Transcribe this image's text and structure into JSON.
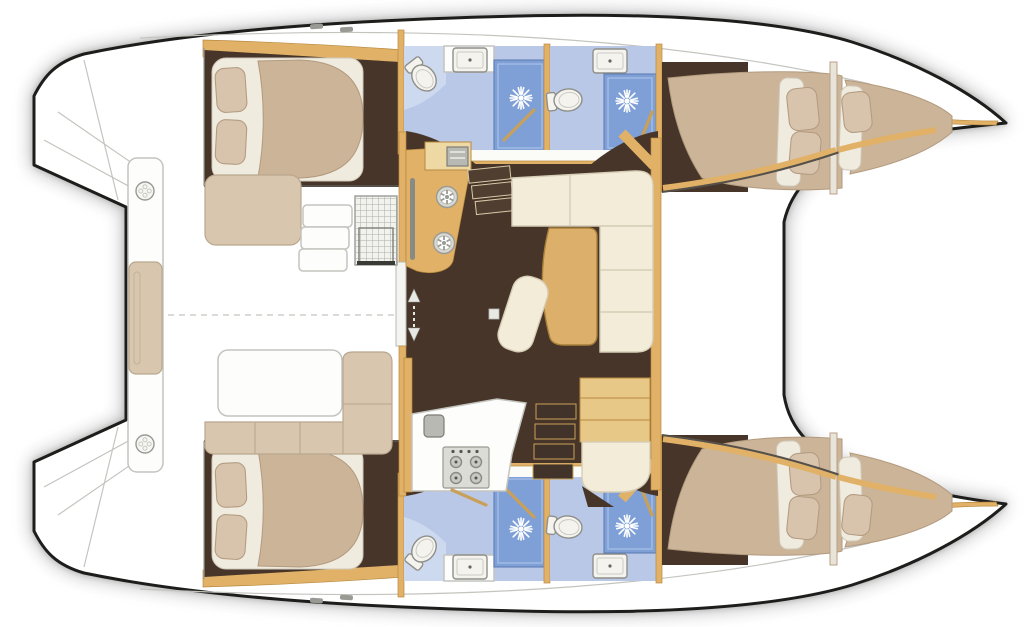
{
  "title": "Catamaran interior layout — overhead floor plan",
  "vessel": {
    "type": "catamaran",
    "view": "top-down interior plan",
    "hulls": 2,
    "cabins": 4,
    "bathrooms": 4
  },
  "colors": {
    "hull_outline": "#1d1d1b",
    "deck_white": "#ffffff",
    "shadow": "rgba(120,120,120,0.45)",
    "line_grey": "#c4c4bf",
    "steel_grey": "#b9b9b3",
    "floor_line": "#55504a",
    "wood_trim": "#e0b166",
    "wood_light": "#eed9a4",
    "wood_dark": "#b8893f",
    "table_wood": "#dcb06a",
    "stair_wood": "#c9a05a",
    "floor_dark": "#463528",
    "sofa_cream": "#f3ecd9",
    "sofa_edge": "#d6cdb5",
    "cushion_tan": "#d8c6ae",
    "cushion_edge": "#b9a88e",
    "bed_quilt": "#ccb499",
    "bed_quilt_edge": "#b29a7e",
    "bed_sheet": "#f0ebdf",
    "pillow": "#d8c4ad",
    "pillow_edge": "#b49c82",
    "bath_floor": "#b9c8e7",
    "bath_panel": "#cdd9ef",
    "shower_blue": "#7fa0d6",
    "shower_edge": "#5978b2",
    "fixture_white": "#f5f3ee",
    "fixture_stroke": "#8f8f89"
  },
  "areas": {
    "port_hull": {
      "label": "Port hull (top)",
      "rooms": [
        "aft double cabin",
        "bathroom with shower",
        "bathroom with shower",
        "forward double cabin",
        "forepeak berth"
      ]
    },
    "starboard_hull": {
      "label": "Starboard hull (bottom)",
      "rooms": [
        "aft double cabin",
        "bathroom with shower",
        "bathroom with shower",
        "forward double cabin",
        "forepeak berth"
      ]
    },
    "saloon": {
      "label": "Saloon and galley",
      "features": [
        "galley counter with twin rings",
        "L-shaped sofa",
        "dining table",
        "chaise seat",
        "galley counter with 4-burner stove and sink",
        "navigation desk with seat",
        "companionway stairs port",
        "companionway stairs starboard"
      ]
    },
    "cockpit": {
      "label": "Aft cockpit",
      "features": [
        "transom bench with cushion",
        "deck hatch",
        "deck hatch",
        "side seat",
        "boarding steps",
        "grid hatch",
        "cockpit table",
        "L-shaped cockpit seat"
      ]
    }
  },
  "fixtures": {
    "toilets": 4,
    "showers": 4,
    "sinks": 4,
    "stove_burners": 4,
    "galley_rings": 2,
    "deck_hatches": 2
  }
}
